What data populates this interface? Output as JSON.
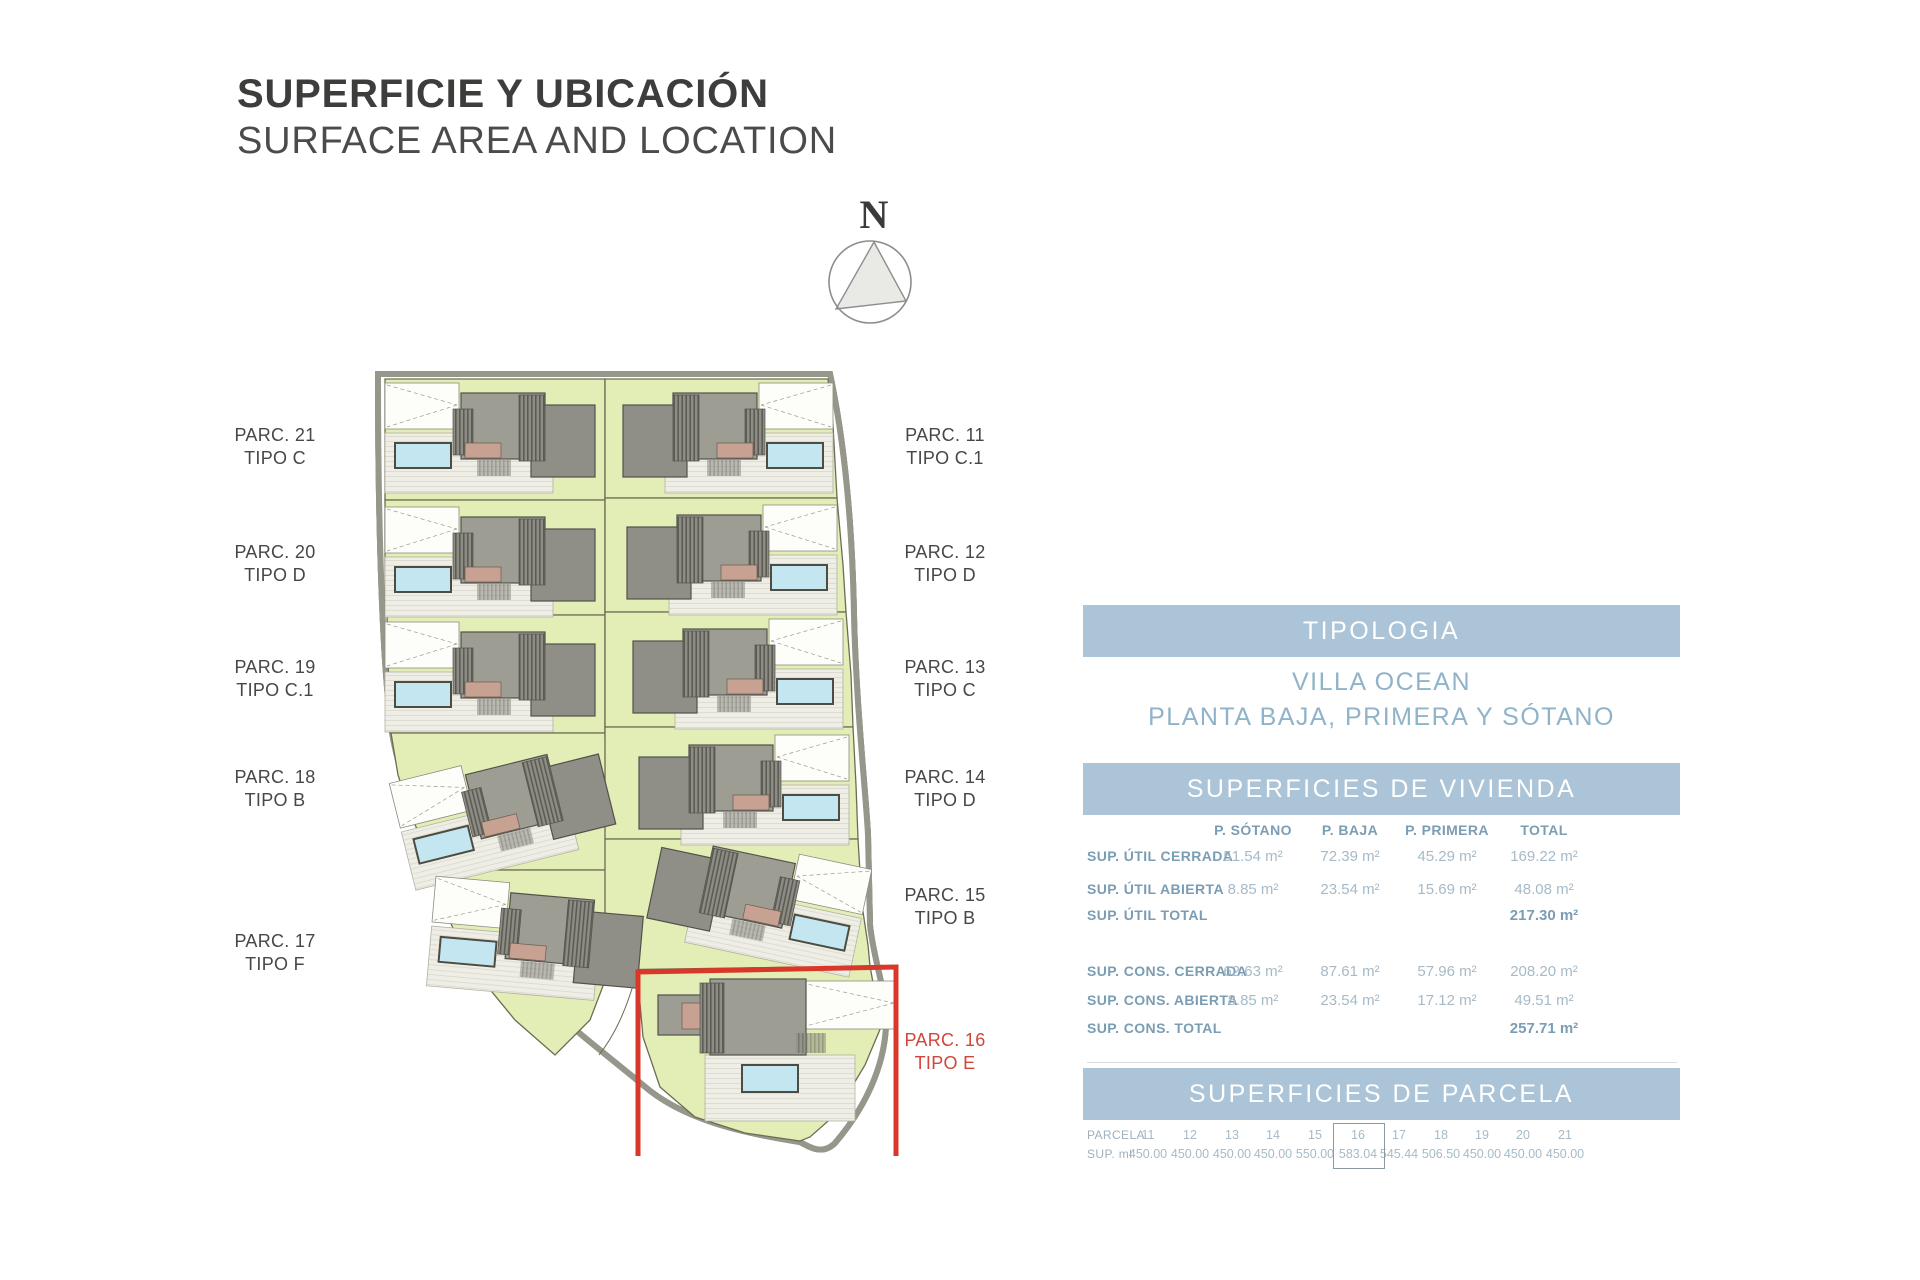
{
  "header": {
    "title": "SUPERFICIE Y UBICACIÓN",
    "subtitle": "SURFACE AREA AND LOCATION"
  },
  "compass": {
    "label": "N"
  },
  "plan": {
    "highlight_color": "#d2453a",
    "parcels_left": [
      {
        "parc": "PARC. 21",
        "tipo": "TIPO C"
      },
      {
        "parc": "PARC. 20",
        "tipo": "TIPO D"
      },
      {
        "parc": "PARC. 19",
        "tipo": "TIPO C.1"
      },
      {
        "parc": "PARC. 18",
        "tipo": "TIPO B"
      },
      {
        "parc": "PARC. 17",
        "tipo": "TIPO F"
      }
    ],
    "parcels_right": [
      {
        "parc": "PARC. 11",
        "tipo": "TIPO C.1"
      },
      {
        "parc": "PARC. 12",
        "tipo": "TIPO D"
      },
      {
        "parc": "PARC. 13",
        "tipo": "TIPO C"
      },
      {
        "parc": "PARC. 14",
        "tipo": "TIPO D"
      },
      {
        "parc": "PARC. 15",
        "tipo": "TIPO B"
      },
      {
        "parc": "PARC. 16",
        "tipo": "TIPO E"
      }
    ]
  },
  "tipologia": {
    "header": "TIPOLOGIA",
    "villa": "VILLA OCEAN",
    "plantas": "PLANTA BAJA, PRIMERA Y SÓTANO"
  },
  "vivienda": {
    "header": "SUPERFICIES DE VIVIENDA",
    "columns": [
      "P. SÓTANO",
      "P. BAJA",
      "P. PRIMERA",
      "TOTAL"
    ],
    "rows": [
      {
        "label": "SUP. ÚTIL CERRADA",
        "sotano": "51.54 m²",
        "baja": "72.39 m²",
        "primera": "45.29 m²",
        "total": "169.22 m²"
      },
      {
        "label": "SUP. ÚTIL ABIERTA",
        "sotano": "8.85 m²",
        "baja": "23.54 m²",
        "primera": "15.69 m²",
        "total": "48.08 m²"
      },
      {
        "label": "SUP. ÚTIL TOTAL",
        "sotano": "",
        "baja": "",
        "primera": "",
        "total": "217.30 m²"
      },
      {
        "label": "SUP. CONS. CERRADA",
        "sotano": "62.63 m²",
        "baja": "87.61 m²",
        "primera": "57.96 m²",
        "total": "208.20 m²"
      },
      {
        "label": "SUP. CONS. ABIERTA",
        "sotano": "8.85 m²",
        "baja": "23.54 m²",
        "primera": "17.12 m²",
        "total": "49.51 m²"
      },
      {
        "label": "SUP. CONS. TOTAL",
        "sotano": "",
        "baja": "",
        "primera": "",
        "total": "257.71 m²"
      }
    ]
  },
  "parcela": {
    "header": "SUPERFICIES DE PARCELA",
    "row1_label": "PARCELA",
    "row2_label": "SUP. ml",
    "cols": [
      {
        "num": "11",
        "sup": "450.00"
      },
      {
        "num": "12",
        "sup": "450.00"
      },
      {
        "num": "13",
        "sup": "450.00"
      },
      {
        "num": "14",
        "sup": "450.00"
      },
      {
        "num": "15",
        "sup": "550.00"
      },
      {
        "num": "16",
        "sup": "583.04"
      },
      {
        "num": "17",
        "sup": "545.44"
      },
      {
        "num": "18",
        "sup": "506.50"
      },
      {
        "num": "19",
        "sup": "450.00"
      },
      {
        "num": "20",
        "sup": "450.00"
      },
      {
        "num": "21",
        "sup": "450.00"
      }
    ]
  }
}
